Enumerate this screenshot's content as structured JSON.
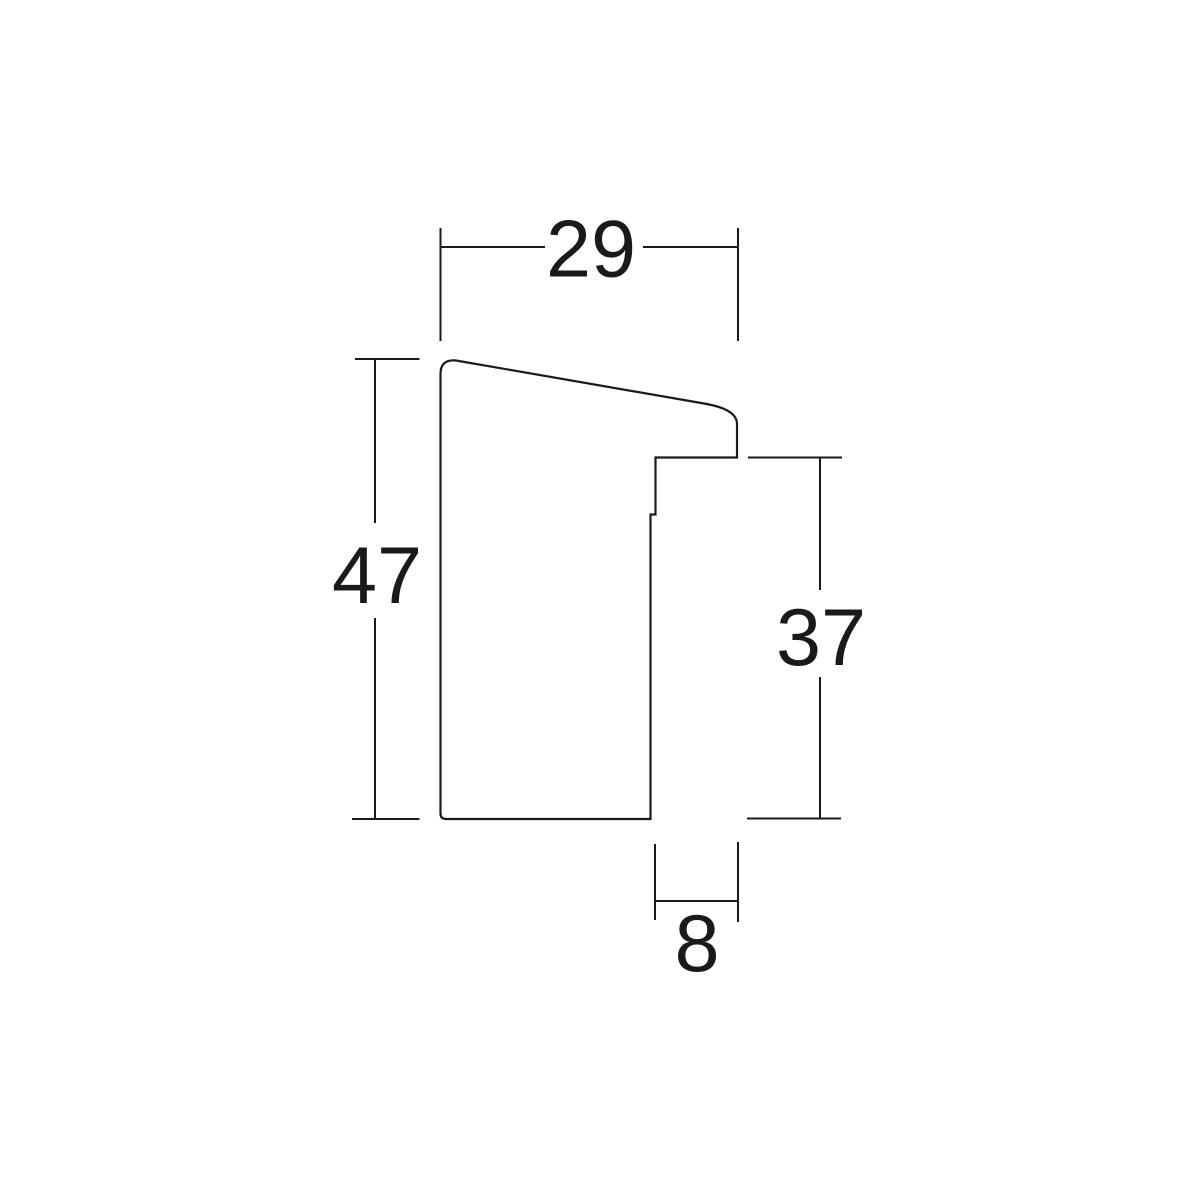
{
  "dimensions": {
    "top_width": "29",
    "left_height": "47",
    "right_height": "37",
    "bottom_width": "8"
  },
  "style": {
    "line_color": "#1a1a1a",
    "text_color": "#1a1a1a",
    "background_color": "#ffffff"
  }
}
